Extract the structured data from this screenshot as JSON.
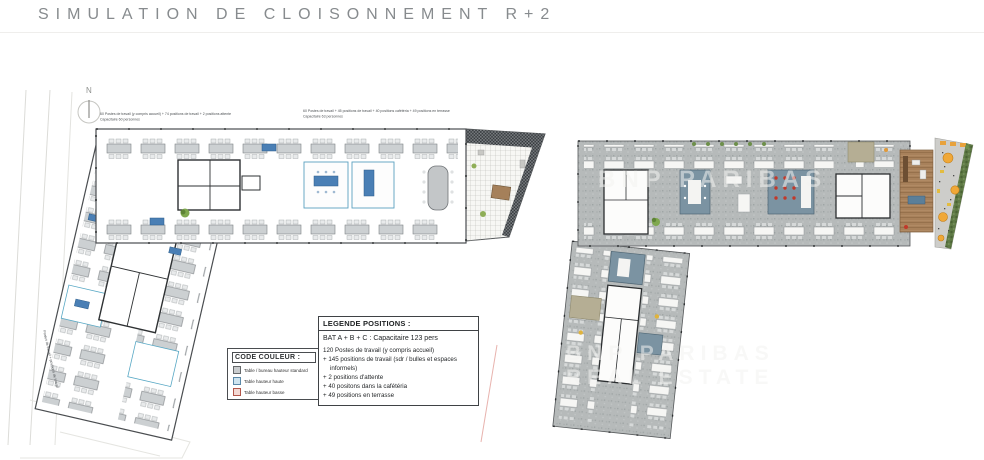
{
  "header": {
    "title": "SIMULATION DE CLOISONNEMENT R+2"
  },
  "plan_left": {
    "north_label": "N",
    "annotation_a": {
      "line1": "60 Postes de travail (y compris accueil) + 74 positions de travail + 2 positions attente",
      "line2": "Capacitaire 60 personnes"
    },
    "annotation_b": {
      "line1": "60 Postes de travail + 45 positions de travail + 40 positions cafétéria + 49 positions en terrasse",
      "line2": "Capacitaire 63 personnes"
    },
    "edge_annotation": "Postes de travail + positions de travail"
  },
  "plan_right": {
    "watermark_line1": "BNP PARIBAS",
    "watermark_line2": "REAL ESTATE"
  },
  "legend_color": {
    "title": "CODE COULEUR :",
    "items": [
      {
        "label": "Table / bureau hauteur standard",
        "swatch_style": "background:#c9ccce;border:1px solid #66696b"
      },
      {
        "label": "Table hauteur haute",
        "swatch_style": "background:#cfe4ef;border:1px solid #5b89a8"
      },
      {
        "label": "Table hauteur basse",
        "swatch_style": "background:#f3d9d4;border:1px solid #b2564a"
      }
    ]
  },
  "legend_positions": {
    "title": "LEGENDE POSITIONS :",
    "capacity": "BAT A + B + C : Capacitaire 123 pers",
    "lines": [
      "120 Postes de travail (y compris accueil)",
      "+ 145 positions de travail (sdr / bulles et espaces informels)",
      "+ 2 positions d'attente",
      "+ 40 positons dans la cafétéria",
      "+ 49 positions en terrasse"
    ]
  },
  "colors": {
    "accent_table_blue": "#4a7fb5",
    "meeting_room_slate": "#7b93a2",
    "carpet_gray": "#b6baba",
    "cafeteria_wood": "#a8815b",
    "terrace_orange": "#f0a838",
    "hedge_green": "#5f7a45"
  }
}
